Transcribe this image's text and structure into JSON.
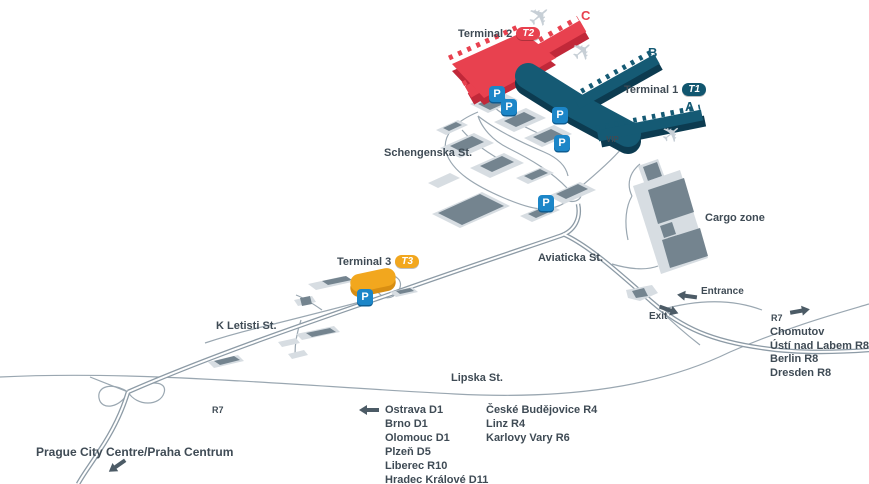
{
  "map": {
    "labels": {
      "terminal2": "Terminal 2",
      "terminal2_badge": "T2",
      "terminal1": "Terminal 1",
      "terminal1_badge": "T1",
      "terminal3": "Terminal 3",
      "terminal3_badge": "T3",
      "pier_a": "A",
      "pier_b": "B",
      "pier_c": "C",
      "vip": "VIP",
      "schengenska": "Schengenska St.",
      "aviaticka": "Aviaticka St.",
      "cargo_zone": "Cargo zone",
      "k_letisti": "K Letisti St.",
      "lipska": "Lipska St.",
      "entrance": "Entrance",
      "exit": "Exit",
      "r7_west": "R7",
      "r7_east": "R7",
      "prague_centre": "Prague City Centre/Praha Centrum",
      "parking_badge": "P"
    },
    "destinations": {
      "north_east": [
        "Chomutov",
        "Ústí nad Labem R8",
        "Berlin R8",
        "Dresden R8"
      ],
      "south_col1": [
        "Ostrava D1",
        "Brno D1",
        "Olomouc D1",
        "Plzeň D5",
        "Liberec R10",
        "Hradec Králové D11"
      ],
      "south_col2": [
        "České Budějovice R4",
        "Linz R4",
        "Karlovy Vary R6"
      ]
    },
    "icons": {
      "plane": "✈"
    },
    "colors": {
      "terminal1_teal": "#155a74",
      "terminal1_shadow": "#0c3b50",
      "terminal2_red": "#e8414f",
      "terminal2_shadow": "#c12839",
      "terminal3_yellow": "#f2a71e",
      "terminal3_shadow": "#d88e12",
      "parking_blue": "#1c86c8",
      "road_gray": "#97a4ae",
      "building_light": "#d7dde2",
      "building_dark": "#74848f",
      "text_dark": "#3f4b55",
      "plane_gray": "#c7cfd6"
    }
  }
}
